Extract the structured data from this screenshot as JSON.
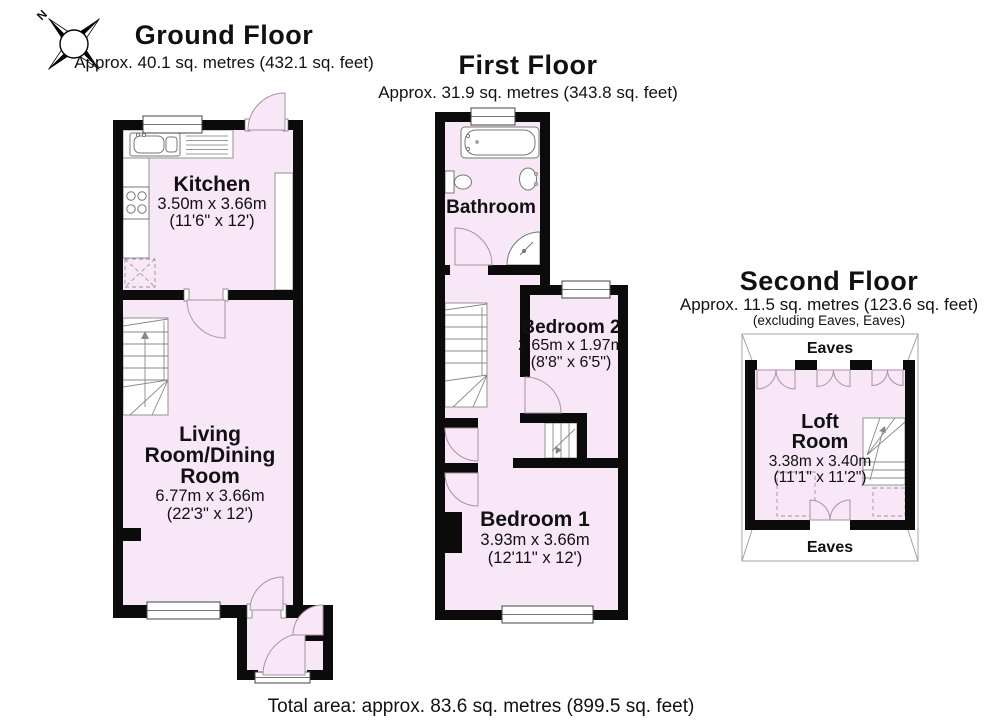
{
  "page": {
    "total_area": "Total area: approx. 83.6 sq. metres (899.5 sq. feet)"
  },
  "compass": {
    "north": "N"
  },
  "colors": {
    "room_fill": "#f8e7f6",
    "wall": "#0b0b0b",
    "fixture_line": "#777777",
    "arc_line": "#a791a7"
  },
  "ground": {
    "title": "Ground Floor",
    "area": "Approx. 40.1 sq. metres (432.1 sq. feet)",
    "kitchen": {
      "name": "Kitchen",
      "metric": "3.50m x 3.66m",
      "imperial": "(11'6\" x 12')"
    },
    "living": {
      "line1": "Living",
      "line2": "Room/Dining",
      "line3": "Room",
      "metric": "6.77m x 3.66m",
      "imperial": "(22'3\" x 12')"
    }
  },
  "first": {
    "title": "First Floor",
    "area": "Approx. 31.9 sq. metres (343.8 sq. feet)",
    "bathroom": {
      "name": "Bathroom"
    },
    "bedroom2": {
      "name": "Bedroom 2",
      "metric": "2.65m x 1.97m",
      "imperial": "(8'8\" x 6'5\")"
    },
    "bedroom1": {
      "name": "Bedroom 1",
      "metric": "3.93m x 3.66m",
      "imperial": "(12'11\" x 12')"
    }
  },
  "second": {
    "title": "Second Floor",
    "area": "Approx. 11.5 sq. metres (123.6 sq. feet)",
    "note": "(excluding Eaves, Eaves)",
    "eaves_top": "Eaves",
    "eaves_bottom": "Eaves",
    "loft": {
      "line1": "Loft",
      "line2": "Room",
      "metric": "3.38m x 3.40m",
      "imperial": "(11'1\" x 11'2\")"
    }
  }
}
